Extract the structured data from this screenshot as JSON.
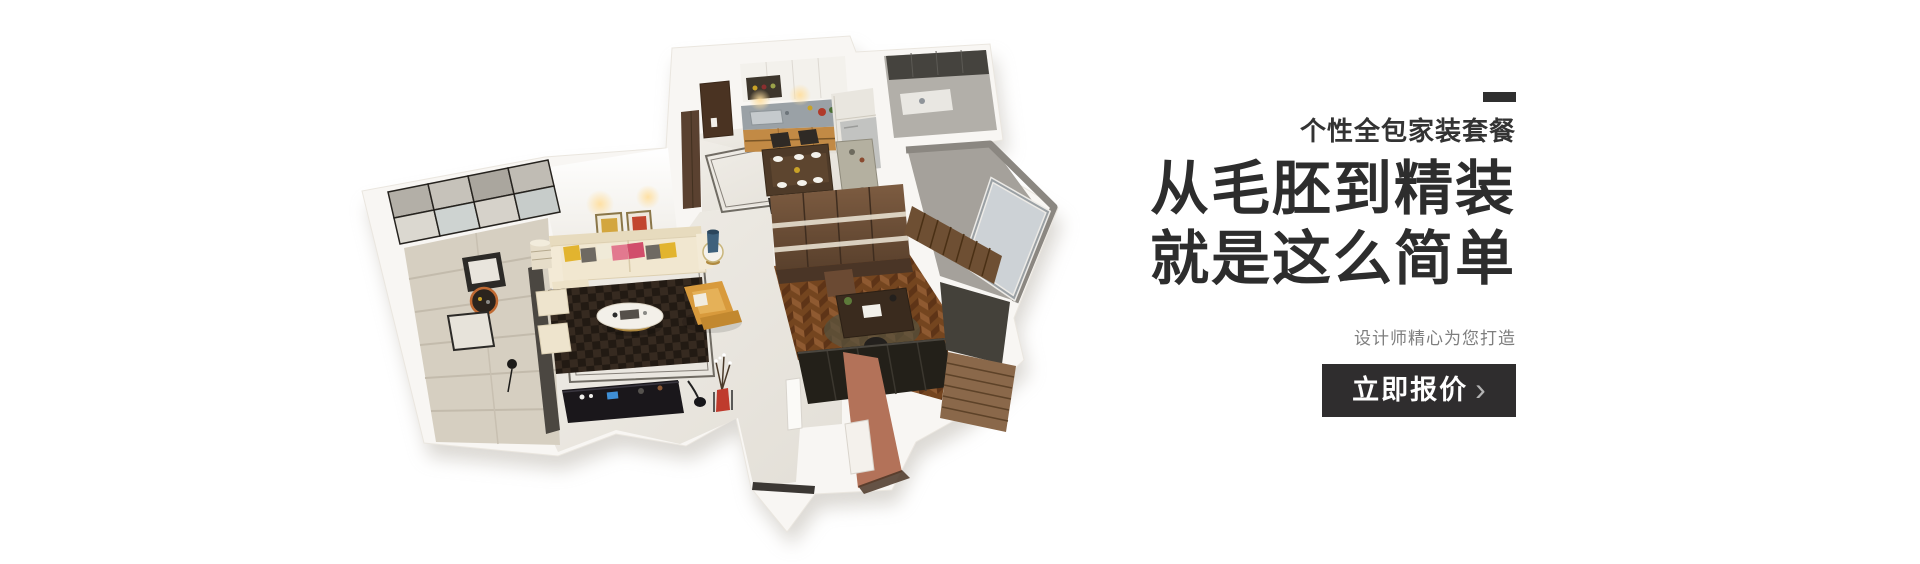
{
  "promo": {
    "category": "个性全包家装套餐",
    "title_line1": "从毛胚到精装",
    "title_line2": "就是这么简单",
    "description": "设计师精心为您打造",
    "cta": {
      "label": "立即报价",
      "chevron": "›"
    },
    "colors": {
      "accent_mark": "#2f2f2f",
      "category_text": "#333333",
      "title_text": "#2d2d2d",
      "description_text": "#7e7e7e",
      "cta_background": "#2f2d2e",
      "cta_text": "#ffffff",
      "cta_chevron": "#b3b3b3"
    }
  },
  "floorplan": {
    "type": "isometric-3d-apartment-render",
    "rooms": [
      "balcony",
      "living-room",
      "dining-room",
      "kitchen",
      "utility-balcony",
      "bathroom",
      "wardrobe",
      "study-bedroom",
      "entrance-hall"
    ],
    "palette": {
      "wall_white": "#f8f6f3",
      "floor_marble": "#ece9e3",
      "balcony_tile": "#d6cfc1",
      "kitchen_wood": "#c28a45",
      "counter_gray": "#9aa1a6",
      "wardrobe_brown": "#6b4a33",
      "herringbone_wood": "#74451f",
      "rug_dark": "#221a13",
      "sofa_cream": "#f1e7d0",
      "pillow_yellow": "#e2b42f",
      "pillow_pink": "#e2798f",
      "pillow_red": "#d14e6b",
      "tv_console_black": "#1a171b",
      "terracotta_wall": "#b37259",
      "inlay_line": "#5b564e"
    }
  }
}
